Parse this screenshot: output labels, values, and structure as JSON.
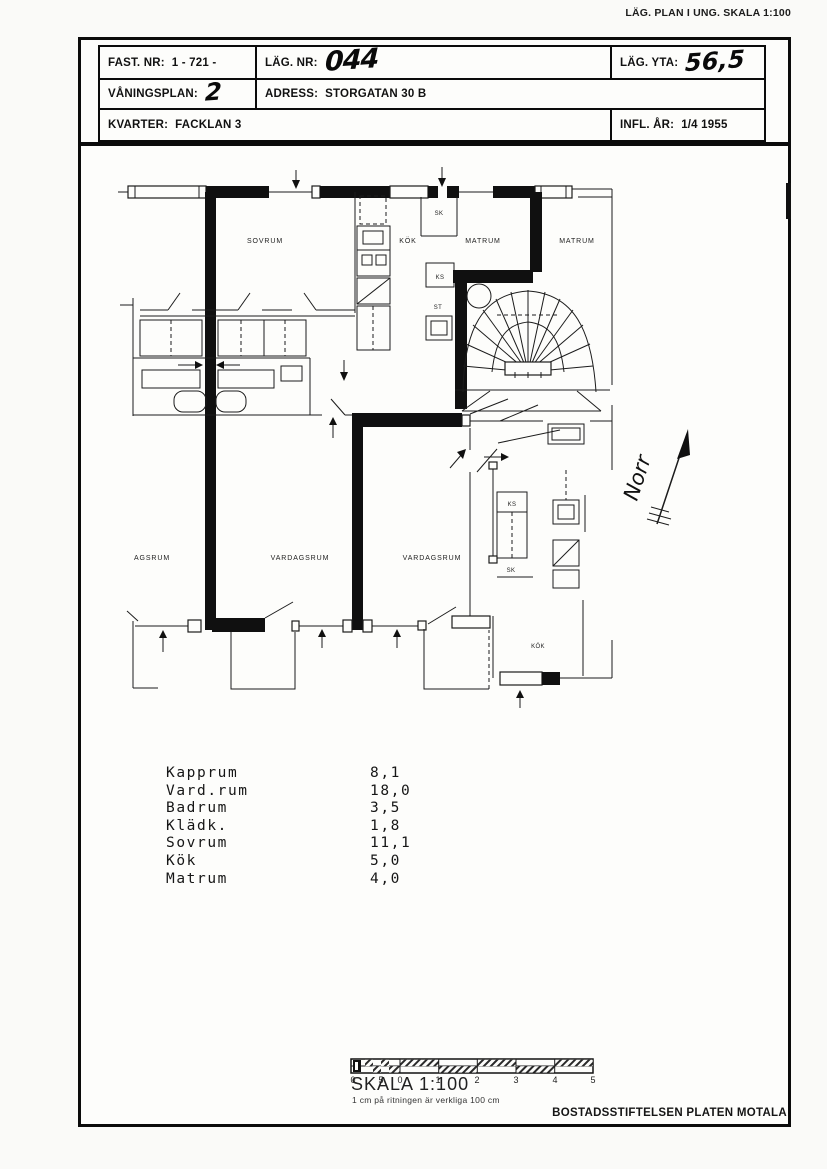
{
  "page": {
    "corner_label": "LÄG. PLAN I UNG. SKALA 1:100",
    "footer": "BOSTADSSTIFTELSEN PLATEN MOTALA"
  },
  "header": {
    "fast_nr_label": "FAST. NR:",
    "fast_nr_value": "1 - 721 -",
    "lag_nr_label": "LÄG. NR:",
    "lag_nr_value": "044",
    "lag_yta_label": "LÄG. YTA:",
    "lag_yta_value": "56,5",
    "vaningsplan_label": "VÅNINGSPLAN:",
    "vaningsplan_value": "2",
    "adress_label": "ADRESS:",
    "adress_value": "STORGATAN 30 B",
    "kvarter_label": "KVARTER:",
    "kvarter_value": "FACKLAN 3",
    "infl_ar_label": "INFL. ÅR:",
    "infl_ar_value": "1/4  1955"
  },
  "plan": {
    "rooms": {
      "sovrum": "SOVRUM",
      "kok_top": "KÖK",
      "sk_top": "SK",
      "matrum_left": "MATRUM",
      "matrum_right": "MATRUM",
      "ks_top": "KS",
      "st_top": "ST",
      "agsrum": "AGSRUM",
      "vardagsrum_left": "VARDAGSRUM",
      "vardagsrum_right": "VARDAGSRUM",
      "ks_bottom": "KS",
      "sk_bottom": "SK",
      "kok_bottom": "KÖK",
      "norr": "Norr"
    }
  },
  "area_list": {
    "rows": [
      {
        "name": "Kapprum",
        "area": "8,1"
      },
      {
        "name": "Vard.rum",
        "area": "18,0"
      },
      {
        "name": "Badrum",
        "area": "3,5"
      },
      {
        "name": "Klädk.",
        "area": "1,8"
      },
      {
        "name": "Sovrum",
        "area": "11,1"
      },
      {
        "name": "Kök",
        "area": "5,0"
      },
      {
        "name": "Matrum",
        "area": "4,0"
      }
    ]
  },
  "scale_bar": {
    "title": "SKALA 1:100",
    "subtitle": "1 cm på ritningen är verkliga 100 cm",
    "ticks": [
      "0",
      "5",
      "0",
      "1",
      "2",
      "3",
      "4",
      "5"
    ]
  }
}
